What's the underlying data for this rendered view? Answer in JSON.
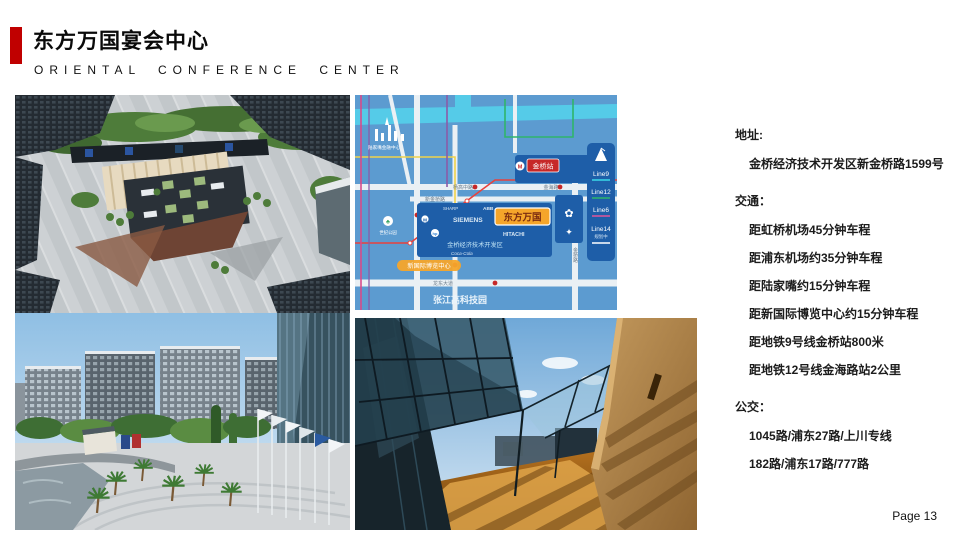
{
  "slide": {
    "title": "东方万国宴会中心",
    "subtitle": "ORIENTAL CONFERENCE CENTER",
    "page_label": "Page 13",
    "accent_red": "#C00000"
  },
  "info": {
    "address": {
      "heading": "地址:",
      "items": [
        "金桥经济技术开发区新金桥路1599号"
      ]
    },
    "transport": {
      "heading": "交通：",
      "items": [
        "距虹桥机场45分钟车程",
        "距浦东机场约35分钟车程",
        "距陆家嘴约15分钟车程",
        "距新国际博览中心约15分钟车程",
        "距地铁9号线金桥站800米",
        "距地铁12号线金海路站2公里"
      ]
    },
    "bus": {
      "heading": "公交：",
      "items": [
        "1045路/浦东27路/上川专线",
        "182路/浦东17路/777路"
      ]
    }
  },
  "map": {
    "landmark_label": "陆家嘴金融中心",
    "park_label": "世纪公园",
    "station_label": "金桥站",
    "venue_label": "东方万国",
    "expo_label": "新国际博览中心",
    "district_label": "张江高科技园",
    "zone_label": "金桥经济技术开发区",
    "companies": {
      "c0": "SHARP",
      "c1": "ABB",
      "c2": "SIEMENS",
      "c3": "HITACHI",
      "c4": "Coca-Cola"
    },
    "roads": {
      "yanggao": "杨高中路",
      "jinhai": "金海路",
      "xinjinqiao": "新金桥路",
      "longdong": "龙东大道",
      "jinqiao": "金桥路"
    },
    "legend": {
      "l0": {
        "label": "Line9",
        "color": "#3AD9E8"
      },
      "l1": {
        "label": "Line12",
        "color": "#2FB56A"
      },
      "l2": {
        "label": "Line6",
        "color": "#E0559A"
      },
      "l3": {
        "label": "Line14",
        "sub": "规划中",
        "color": "#FFFFFF"
      }
    },
    "colors": {
      "bg": "#5C9BD0",
      "block": "#1E5EA8",
      "river": "#55CBE8",
      "road": "#EAF0F4",
      "badge_red": "#C62828",
      "badge_orange": "#F5A52A"
    }
  }
}
